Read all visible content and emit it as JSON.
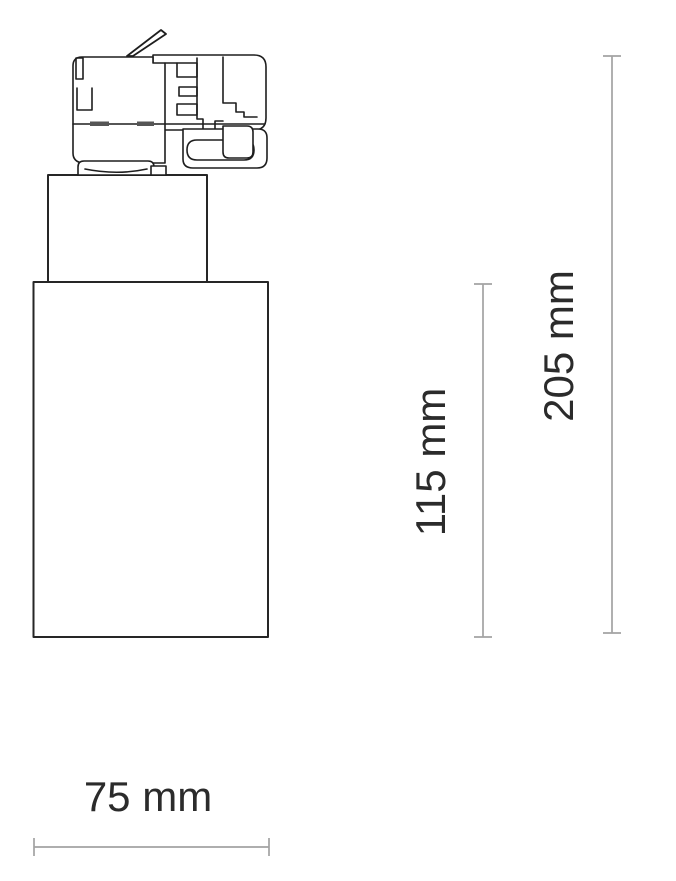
{
  "drawing": {
    "subject": "track spotlight dimension drawing",
    "labels": {
      "width": "75 mm",
      "housing_height": "115 mm",
      "total_height": "205 mm"
    },
    "colors": {
      "outline": "#1e1e1e",
      "dimension_line": "#a3a3a3",
      "label_text": "#2b2b2b",
      "background": "#ffffff"
    }
  }
}
